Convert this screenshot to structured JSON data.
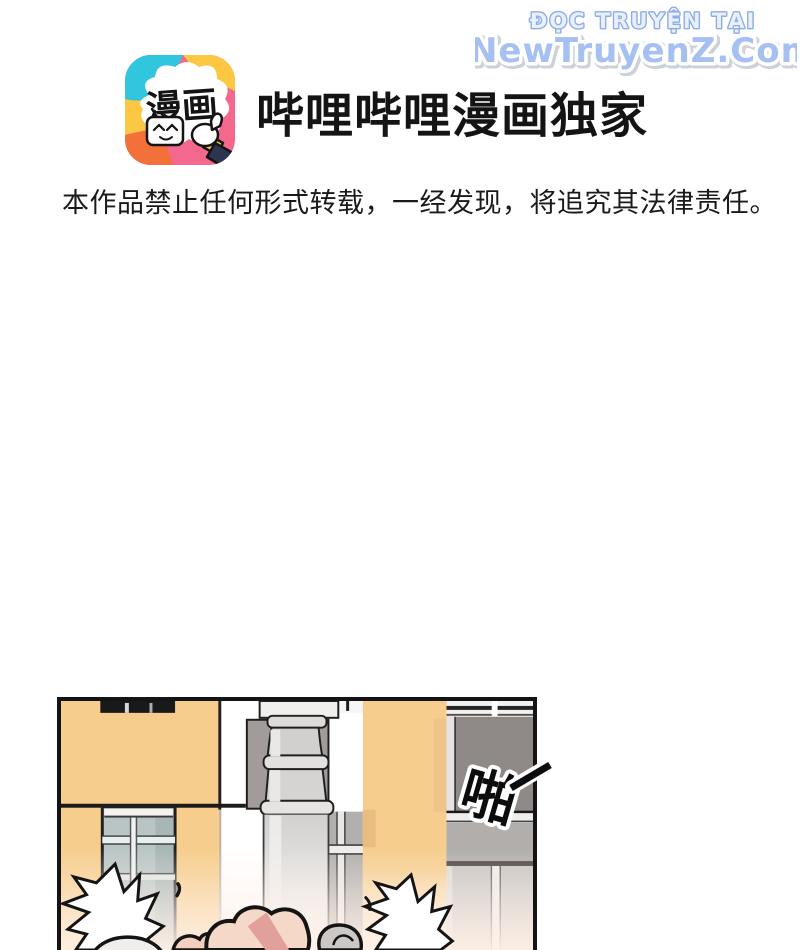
{
  "watermark": {
    "line1": "ĐỌC TRUYỆN TẠI",
    "line2": "NewTruyenZ.Com",
    "fill_blue": "#a6c0f2",
    "outline_blue": "#8cade9"
  },
  "header": {
    "logo_text": "漫画",
    "title": "哔哩哔哩漫画独家"
  },
  "notice": {
    "text": "本作品禁止任何形式转载，一经发现，将追究其法律责任。"
  },
  "panel": {
    "sfx": "啪"
  },
  "colors": {
    "wall_orange": "#f6cd8c",
    "wall_orange_shadow": "#e9bc80",
    "window_glass": "#b9c5c5",
    "gray_wall": "#a19c99",
    "dark_pane": "#8f8a87",
    "pipe_gray": "#d6d4d2",
    "skin": "#f6d8c9",
    "pink_band": "#e2a09b",
    "logo_cyan": "#2fc6de",
    "logo_yellow": "#fcc843",
    "logo_pink": "#f4688d",
    "logo_orange": "#f4703a"
  }
}
